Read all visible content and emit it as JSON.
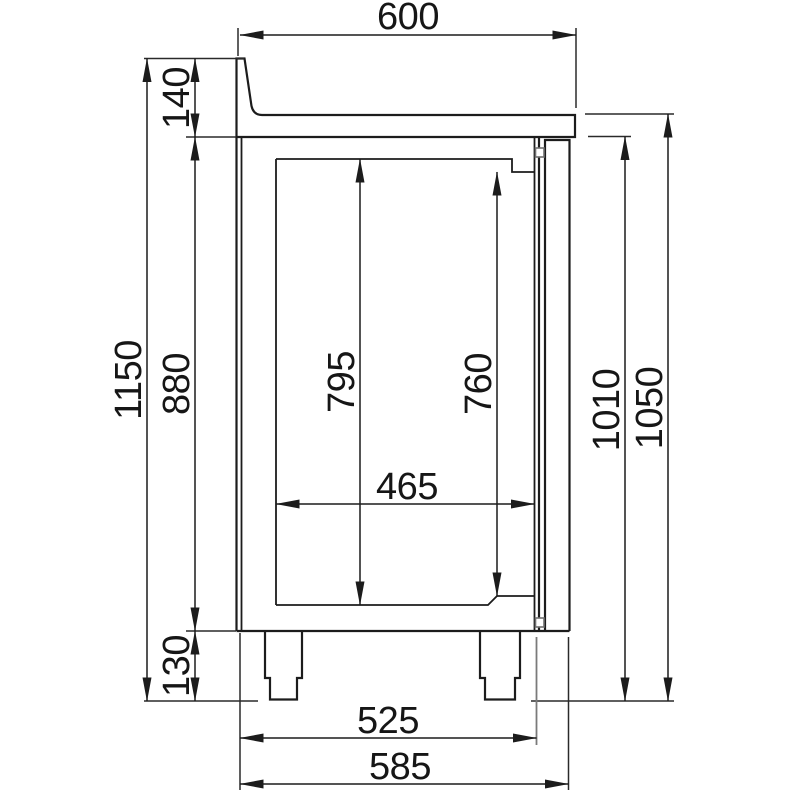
{
  "drawing": {
    "kind": "technical-dimension-drawing",
    "view": "side-section-of-refrigerated-counter",
    "unit": "mm",
    "colors": {
      "background": "#ffffff",
      "line": "#1c1c1c",
      "secondary_line": "#7a7a7a",
      "text": "#161616"
    }
  },
  "dims": {
    "d600": {
      "value": "600",
      "orientation": "horizontal",
      "measures": "worktop-depth-top"
    },
    "d140": {
      "value": "140",
      "orientation": "vertical",
      "measures": "backsplash-and-worktop-height"
    },
    "d1150": {
      "value": "1150",
      "orientation": "vertical",
      "measures": "overall-height-with-backsplash"
    },
    "d880": {
      "value": "880",
      "orientation": "vertical",
      "measures": "body-height"
    },
    "d795": {
      "value": "795",
      "orientation": "vertical",
      "measures": "inner-compartment-height"
    },
    "d760": {
      "value": "760",
      "orientation": "vertical",
      "measures": "door-opening-height"
    },
    "d465": {
      "value": "465",
      "orientation": "horizontal",
      "measures": "inner-compartment-depth"
    },
    "d1010": {
      "value": "1010",
      "orientation": "vertical",
      "measures": "height-under-worktop"
    },
    "d1050": {
      "value": "1050",
      "orientation": "vertical",
      "measures": "worktop-height"
    },
    "d130": {
      "value": "130",
      "orientation": "vertical",
      "measures": "leg-height"
    },
    "d525": {
      "value": "525",
      "orientation": "horizontal",
      "measures": "body-depth"
    },
    "d585": {
      "value": "585",
      "orientation": "horizontal",
      "measures": "overall-depth-with-door"
    }
  }
}
